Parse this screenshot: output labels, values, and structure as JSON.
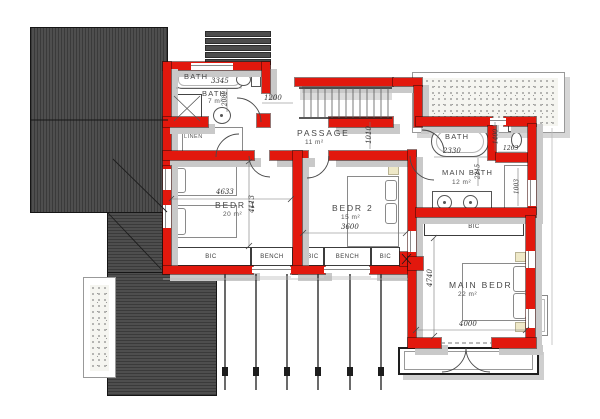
{
  "plan": {
    "colors": {
      "wall": "#e2180d",
      "roof": "#4e4e4e",
      "roof_line": "#3a3a3a",
      "shadow": "#c9c9c9",
      "stipple_bg": "#f5f5f0"
    },
    "bath": {
      "tub_label": "BATH",
      "tub_dim": "3345",
      "room_name": "BATH",
      "room_area": "7 m²",
      "depth_dim": "2082",
      "linen_label": "LINEN"
    },
    "passage": {
      "name": "PASSAGE",
      "area": "11 m²",
      "left_dim": "1200",
      "width_dim": "1010"
    },
    "bedroom1": {
      "name": "BEDR 1",
      "area": "20 m²",
      "width_dim": "4633",
      "depth_dim": "4113"
    },
    "bedroom2": {
      "name": "BEDR 2",
      "area": "15 m²",
      "width_dim": "3600"
    },
    "main_bath": {
      "name": "MAIN BATH",
      "area": "12 m²",
      "tub_label": "BATH",
      "tub_dim": "2330",
      "wc_depth_dim": "1400",
      "wc_width_dim": "1263",
      "depth_dim": "2215",
      "closet_dim": "1003",
      "bic_label": "BIC"
    },
    "main_bedroom": {
      "name": "MAIN BEDR",
      "area": "22 m²",
      "depth_dim": "4740",
      "width_dim": "4000"
    },
    "storage_strip": {
      "cells": [
        "BIC",
        "BENCH",
        "BIC",
        "BENCH",
        "BIC"
      ]
    }
  }
}
